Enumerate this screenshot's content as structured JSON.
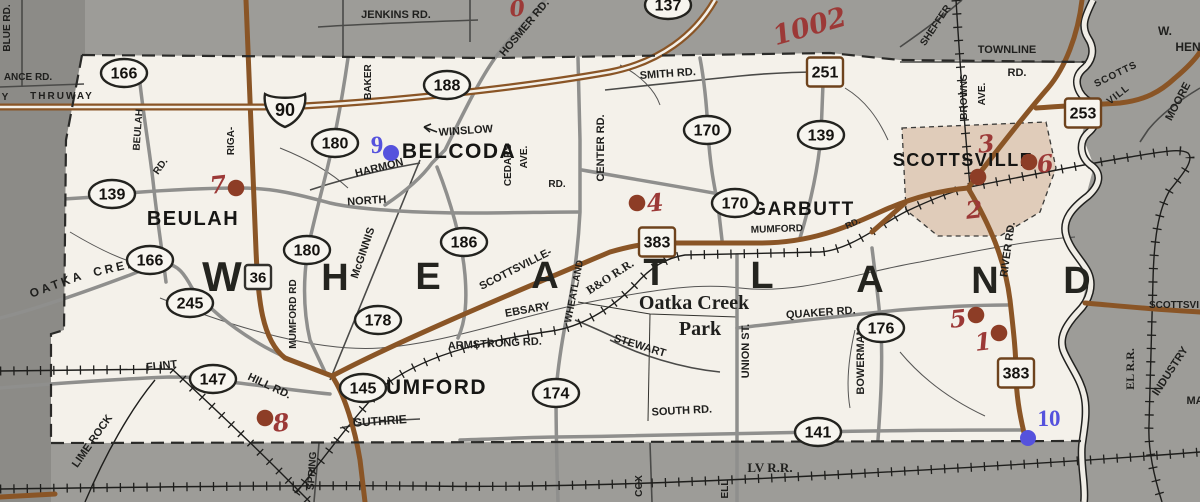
{
  "title": "Town of Wheatland road map",
  "colors": {
    "outside_gray": "#9d9c98",
    "outside_gray_dark": "#8c8b87",
    "township_white": "#f4f1ea",
    "road_brown": "#8a5526",
    "road_gray": "#8f8f8d",
    "minor_road": "#4a4a48",
    "village_pink": "#dcc5b1",
    "rail_black": "#1e1e1c",
    "red_dot": "#8d3d26",
    "red_hand": "#9c3937",
    "blue": "#5552dd",
    "ink": "#1f1f1d"
  },
  "big_letters": {
    "note": "township name spelled across map",
    "items": [
      [
        "W",
        222,
        291
      ],
      [
        "H",
        335,
        290
      ],
      [
        "E",
        428,
        289
      ],
      [
        "A",
        545,
        288
      ],
      [
        "T",
        655,
        285
      ],
      [
        "L",
        762,
        288
      ],
      [
        "A",
        870,
        292
      ],
      [
        "N",
        985,
        293
      ],
      [
        "D",
        1077,
        293
      ]
    ]
  },
  "towns": [
    {
      "t": "BELCODA",
      "x": 459,
      "y": 158,
      "s": 21
    },
    {
      "t": "BEULAH",
      "x": 193,
      "y": 225,
      "s": 20
    },
    {
      "t": "GARBUTT",
      "x": 803,
      "y": 215,
      "s": 19
    },
    {
      "t": "SCOTTSVILLE",
      "x": 963,
      "y": 166,
      "s": 18
    },
    {
      "t": "MUMFORD",
      "x": 427,
      "y": 394,
      "s": 21
    }
  ],
  "labels": [
    {
      "t": "BLUE RD.",
      "x": 10,
      "y": 28,
      "r": -90,
      "s": 10
    },
    {
      "t": "ANCE RD.",
      "x": 28,
      "y": 80,
      "s": 10
    },
    {
      "t": "Y",
      "x": 5,
      "y": 100,
      "s": 10
    },
    {
      "t": "THRUWAY",
      "x": 62,
      "y": 99,
      "s": 10,
      "ls": 2
    },
    {
      "t": "JENKINS RD.",
      "x": 396,
      "y": 18,
      "s": 11
    },
    {
      "t": "HOSMER RD.",
      "x": 527,
      "y": 30,
      "r": -50,
      "s": 11
    },
    {
      "t": "BAKER",
      "x": 371,
      "y": 82,
      "r": -90,
      "s": 10
    },
    {
      "t": "SMITH RD.",
      "x": 668,
      "y": 77,
      "r": -4,
      "s": 11
    },
    {
      "t": "SHEFFER",
      "x": 938,
      "y": 27,
      "r": -56,
      "s": 10
    },
    {
      "t": "TOWNLINE",
      "x": 1007,
      "y": 53,
      "s": 11
    },
    {
      "t": "RD.",
      "x": 1017,
      "y": 76,
      "s": 11
    },
    {
      "t": "BROWNS",
      "x": 967,
      "y": 97,
      "r": -90,
      "s": 10
    },
    {
      "t": "AVE.",
      "x": 985,
      "y": 94,
      "r": -90,
      "s": 10
    },
    {
      "t": "W.",
      "x": 1165,
      "y": 35,
      "s": 12
    },
    {
      "t": "HEN",
      "x": 1188,
      "y": 51,
      "s": 12
    },
    {
      "t": "SCOTTS",
      "x": 1117,
      "y": 77,
      "r": -26,
      "s": 10,
      "ls": 1
    },
    {
      "t": "VILL",
      "x": 1120,
      "y": 97,
      "r": -38,
      "s": 10,
      "ls": 1
    },
    {
      "t": "MOORE",
      "x": 1181,
      "y": 103,
      "r": -62,
      "s": 11
    },
    {
      "t": "WINSLOW",
      "x": 466,
      "y": 134,
      "r": -4,
      "s": 11
    },
    {
      "t": "CEDARS",
      "x": 511,
      "y": 165,
      "r": -90,
      "s": 10
    },
    {
      "t": "AVE.",
      "x": 527,
      "y": 157,
      "r": -90,
      "s": 10
    },
    {
      "t": "RD.",
      "x": 557,
      "y": 187,
      "s": 10
    },
    {
      "t": "CENTER RD.",
      "x": 604,
      "y": 148,
      "r": -90,
      "s": 11
    },
    {
      "t": "HARMON",
      "x": 380,
      "y": 171,
      "r": -14,
      "s": 11
    },
    {
      "t": "NORTH",
      "x": 367,
      "y": 204,
      "r": -4,
      "s": 11
    },
    {
      "t": "BEULAH",
      "x": 141,
      "y": 130,
      "r": -86,
      "s": 10
    },
    {
      "t": "RD.",
      "x": 163,
      "y": 168,
      "r": -55,
      "s": 10
    },
    {
      "t": "RIGA-",
      "x": 234,
      "y": 141,
      "r": -90,
      "s": 10
    },
    {
      "t": "McGINNIS",
      "x": 366,
      "y": 254,
      "r": -71,
      "s": 11
    },
    {
      "t": "MUMFORD RD",
      "x": 296,
      "y": 314,
      "r": -90,
      "s": 10
    },
    {
      "t": "SCOTTSVILLE-",
      "x": 517,
      "y": 272,
      "r": -27,
      "s": 11
    },
    {
      "t": "WHEATLAND",
      "x": 577,
      "y": 292,
      "r": -79,
      "s": 10
    },
    {
      "t": "EBSARY",
      "x": 528,
      "y": 313,
      "r": -10,
      "s": 11
    },
    {
      "t": "ARMSTRONG RD.",
      "x": 495,
      "y": 347,
      "r": -3,
      "s": 11
    },
    {
      "t": "STEWART",
      "x": 639,
      "y": 349,
      "r": 17,
      "s": 11
    },
    {
      "t": "UNION ST.",
      "x": 749,
      "y": 351,
      "r": -90,
      "s": 11
    },
    {
      "t": "QUAKER RD.",
      "x": 821,
      "y": 316,
      "r": -4,
      "s": 11
    },
    {
      "t": "BOWERMAN",
      "x": 864,
      "y": 361,
      "r": -90,
      "s": 11
    },
    {
      "t": "MUMFORD",
      "x": 777,
      "y": 232,
      "r": -2,
      "s": 10
    },
    {
      "t": "RD.",
      "x": 854,
      "y": 226,
      "r": -25,
      "s": 9
    },
    {
      "t": "RIVER RD.",
      "x": 1011,
      "y": 250,
      "r": -82,
      "s": 11
    },
    {
      "t": "OATKA",
      "x": 58,
      "y": 288,
      "r": -20,
      "s": 12,
      "ls": 3
    },
    {
      "t": "CREEK",
      "x": 122,
      "y": 270,
      "r": -13,
      "s": 12,
      "ls": 3
    },
    {
      "t": "FLINT",
      "x": 162,
      "y": 369,
      "r": -6,
      "s": 11
    },
    {
      "t": "HILL RD.",
      "x": 268,
      "y": 389,
      "r": 25,
      "s": 11
    },
    {
      "t": "LIME ROCK",
      "x": 95,
      "y": 443,
      "r": -55,
      "s": 11
    },
    {
      "t": "GUTHRIE",
      "x": 380,
      "y": 425,
      "r": -4,
      "s": 12
    },
    {
      "t": "SPRING",
      "x": 315,
      "y": 471,
      "r": -86,
      "s": 10
    },
    {
      "t": "SOUTH RD.",
      "x": 682,
      "y": 414,
      "r": -3,
      "s": 11
    },
    {
      "t": "COX",
      "x": 642,
      "y": 486,
      "r": -90,
      "s": 10
    },
    {
      "t": "ELL",
      "x": 728,
      "y": 489,
      "r": -90,
      "s": 10
    },
    {
      "t": "SCOTTSVI",
      "x": 1174,
      "y": 308,
      "s": 10
    },
    {
      "t": "INDUSTRY",
      "x": 1173,
      "y": 373,
      "r": -57,
      "s": 11
    },
    {
      "t": "MA",
      "x": 1195,
      "y": 404,
      "s": 11
    }
  ],
  "serif_labels": [
    {
      "t": "Oatka Creek",
      "x": 694,
      "y": 309,
      "s": 20
    },
    {
      "t": "Park",
      "x": 700,
      "y": 335,
      "s": 20
    },
    {
      "t": "LV R.R.",
      "x": 770,
      "y": 472,
      "s": 13
    },
    {
      "t": "B&O R.R.",
      "x": 612,
      "y": 280,
      "r": -33,
      "s": 12
    },
    {
      "t": "EL R.R.",
      "x": 1134,
      "y": 369,
      "r": -90,
      "s": 12
    }
  ],
  "oval_markers": [
    {
      "t": "166",
      "x": 124,
      "y": 73
    },
    {
      "t": "188",
      "x": 447,
      "y": 85
    },
    {
      "t": "180",
      "x": 335,
      "y": 143
    },
    {
      "t": "139",
      "x": 112,
      "y": 194
    },
    {
      "t": "137",
      "x": 668,
      "y": 5
    },
    {
      "t": "170",
      "x": 707,
      "y": 130
    },
    {
      "t": "139",
      "x": 821,
      "y": 135
    },
    {
      "t": "170",
      "x": 735,
      "y": 203
    },
    {
      "t": "186",
      "x": 464,
      "y": 242
    },
    {
      "t": "180",
      "x": 307,
      "y": 250
    },
    {
      "t": "166",
      "x": 150,
      "y": 260
    },
    {
      "t": "245",
      "x": 190,
      "y": 303
    },
    {
      "t": "178",
      "x": 378,
      "y": 320
    },
    {
      "t": "176",
      "x": 881,
      "y": 328
    },
    {
      "t": "147",
      "x": 213,
      "y": 379
    },
    {
      "t": "145",
      "x": 363,
      "y": 388
    },
    {
      "t": "174",
      "x": 556,
      "y": 393
    },
    {
      "t": "141",
      "x": 818,
      "y": 432
    }
  ],
  "square_markers": [
    {
      "t": "251",
      "x": 825,
      "y": 72
    },
    {
      "t": "253",
      "x": 1083,
      "y": 113
    },
    {
      "t": "383",
      "x": 657,
      "y": 242
    },
    {
      "t": "383",
      "x": 1016,
      "y": 373
    },
    {
      "t": "36",
      "x": 258,
      "y": 277,
      "small": true
    }
  ],
  "shield_markers": [
    {
      "t": "90",
      "x": 285,
      "y": 108
    }
  ],
  "red_annotations": {
    "dots": [
      [
        236,
        188
      ],
      [
        637,
        203
      ],
      [
        978,
        177
      ],
      [
        1029,
        162
      ],
      [
        976,
        315
      ],
      [
        999,
        333
      ],
      [
        265,
        418
      ]
    ],
    "numbers": [
      {
        "t": "7",
        "x": 219,
        "y": 193
      },
      {
        "t": "4",
        "x": 656,
        "y": 211
      },
      {
        "t": "3",
        "x": 987,
        "y": 152
      },
      {
        "t": "6",
        "x": 1046,
        "y": 172
      },
      {
        "t": "2",
        "x": 975,
        "y": 218
      },
      {
        "t": "5",
        "x": 959,
        "y": 327
      },
      {
        "t": "1",
        "x": 984,
        "y": 350
      },
      {
        "t": "8",
        "x": 282,
        "y": 431
      },
      {
        "t": "1002",
        "x": 812,
        "y": 35,
        "r": -16,
        "s": 27
      },
      {
        "t": "0",
        "x": 518,
        "y": 16,
        "s": 22
      }
    ]
  },
  "blue_annotations": {
    "dots": [
      [
        391,
        153
      ],
      [
        1028,
        438
      ]
    ],
    "numbers": [
      {
        "t": "9",
        "x": 377,
        "y": 153,
        "s": 25
      },
      {
        "t": "10",
        "x": 1049,
        "y": 426,
        "s": 23
      }
    ]
  }
}
